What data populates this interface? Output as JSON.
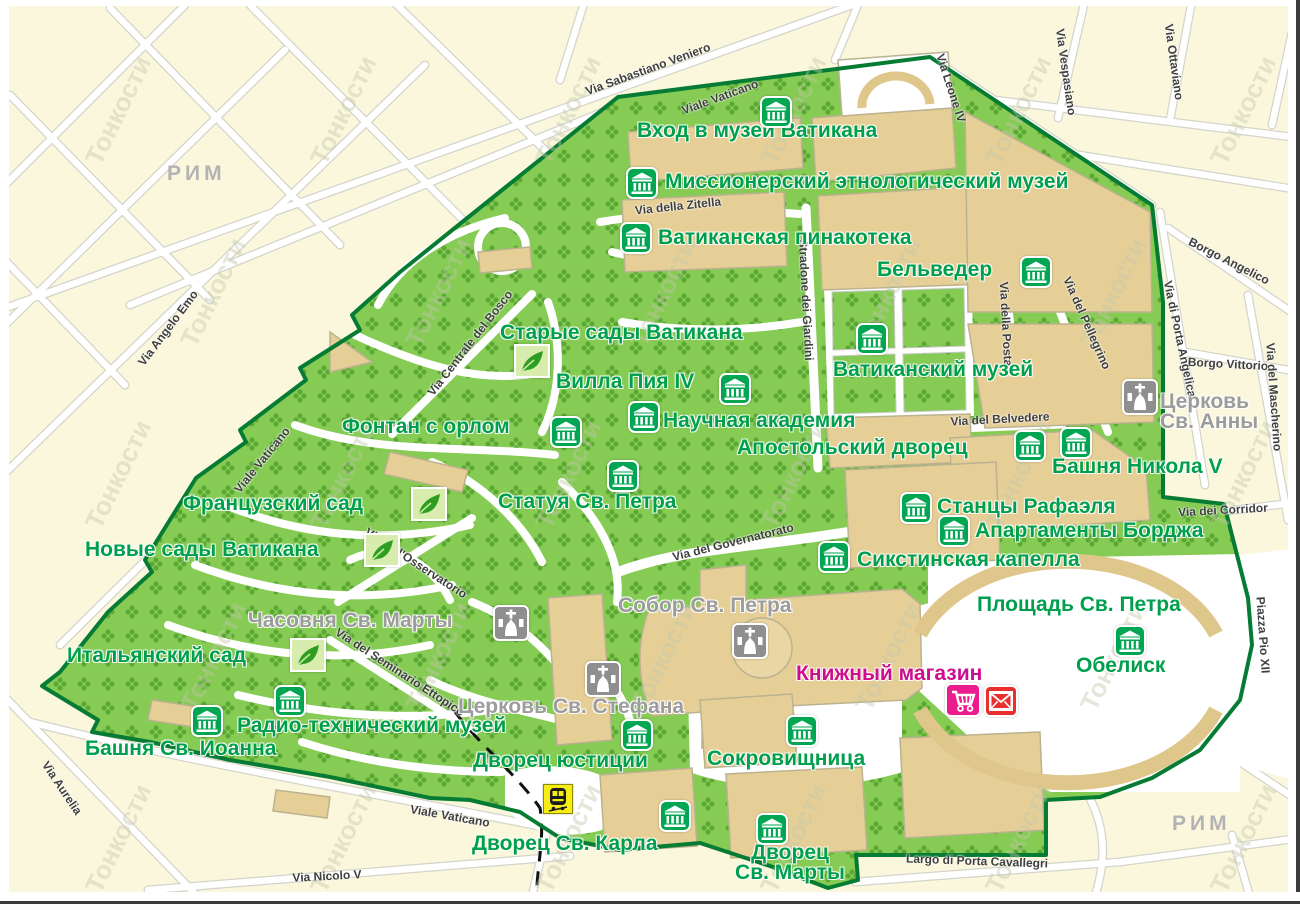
{
  "map": {
    "title": "Карта Ватикана",
    "watermark": "Тонкости",
    "region_labels": [
      {
        "id": "rim-nw",
        "label": "РИМ",
        "x": 167,
        "y": 162
      },
      {
        "id": "rim-se",
        "label": "РИМ",
        "x": 1172,
        "y": 812
      }
    ],
    "colors": {
      "outside_cream": "#FAF7DC",
      "vatican_green": "#85CB54",
      "pattern_green": "#5AA833",
      "building_tan": "#E6CF97",
      "border_green": "#067B33",
      "museum_icon_green": "#00A651",
      "label_green": "#009F4D",
      "label_gray": "#9C9C9C",
      "label_magenta": "#CC0D8E",
      "cart_pink": "#EC1C8E",
      "envelope_red": "#E8312F",
      "train_yellow": "#F7EC13",
      "church_icon_gray": "#8F8F8F"
    },
    "pois": [
      {
        "id": "vhod-muzey",
        "label": "Вход в музей Ватикана",
        "type": "museum",
        "x": 637,
        "y": 121,
        "icons": [
          {
            "type": "museum",
            "x": 776,
            "y": 112
          }
        ]
      },
      {
        "id": "missionerskiy-muzey",
        "label": "Миссионерский этнологический музей",
        "type": "museum",
        "x": 665,
        "y": 172,
        "icons": [
          {
            "type": "museum",
            "x": 642,
            "y": 183
          }
        ]
      },
      {
        "id": "pinakoteka",
        "label": "Ватиканская пинакотека",
        "type": "museum",
        "x": 658,
        "y": 228,
        "icons": [
          {
            "type": "museum",
            "x": 636,
            "y": 238
          }
        ]
      },
      {
        "id": "belveder",
        "label": "Бельведер",
        "type": "museum",
        "x": 877,
        "y": 260,
        "icons": [
          {
            "type": "museum",
            "x": 1036,
            "y": 272
          }
        ]
      },
      {
        "id": "starye-sady",
        "label": "Старые сады Ватикана",
        "type": "garden",
        "x": 500,
        "y": 323,
        "icons": [
          {
            "type": "leaf",
            "x": 532,
            "y": 361
          }
        ]
      },
      {
        "id": "villa-pia",
        "label": "Вилла Пия IV",
        "type": "museum",
        "x": 556,
        "y": 372,
        "icons": [
          {
            "type": "museum",
            "x": 735,
            "y": 389
          }
        ]
      },
      {
        "id": "vatikanskiy-muzey",
        "label": "Ватиканский музей",
        "type": "museum",
        "x": 833,
        "y": 360,
        "icons": [
          {
            "type": "museum",
            "x": 872,
            "y": 339
          }
        ]
      },
      {
        "id": "fontan-s-orlom",
        "label": "Фонтан с орлом",
        "type": "museum",
        "x": 342,
        "y": 417,
        "icons": [
          {
            "type": "museum",
            "x": 566,
            "y": 432
          }
        ]
      },
      {
        "id": "nauchnaya-akademiya",
        "label": "Научная академия",
        "type": "museum",
        "x": 663,
        "y": 411,
        "icons": [
          {
            "type": "museum",
            "x": 644,
            "y": 417
          }
        ]
      },
      {
        "id": "apostolskiy-dvorets",
        "label": "Апостольский дворец",
        "type": "museum",
        "x": 737,
        "y": 438,
        "icons": [
          {
            "type": "museum",
            "x": 1030,
            "y": 446
          }
        ]
      },
      {
        "id": "bashnya-nikola",
        "label": "Башня Никола V",
        "type": "museum",
        "x": 1052,
        "y": 457,
        "icons": [
          {
            "type": "museum",
            "x": 1076,
            "y": 443
          }
        ]
      },
      {
        "id": "tserkov-anny",
        "label": "Церковь\nСв. Анны",
        "type": "church",
        "x": 1160,
        "y": 392,
        "icons": [
          {
            "type": "church",
            "x": 1140,
            "y": 397
          }
        ]
      },
      {
        "id": "stantsy-rafaelya",
        "label": "Станцы Рафаэля",
        "type": "museum",
        "x": 937,
        "y": 497,
        "icons": [
          {
            "type": "museum",
            "x": 916,
            "y": 508
          }
        ]
      },
      {
        "id": "apartamenty-bordzha",
        "label": "Апартаменты Борджа",
        "type": "museum",
        "x": 975,
        "y": 521,
        "icons": [
          {
            "type": "museum",
            "x": 954,
            "y": 531
          }
        ]
      },
      {
        "id": "sikstinskaya-kapella",
        "label": "Сикстинская капелла",
        "type": "museum",
        "x": 857,
        "y": 550,
        "icons": [
          {
            "type": "museum",
            "x": 834,
            "y": 557
          }
        ]
      },
      {
        "id": "sobor-sv-petra",
        "label": "Собор Св. Петра",
        "type": "church",
        "x": 618,
        "y": 596,
        "icons": [
          {
            "type": "church",
            "x": 750,
            "y": 641
          }
        ]
      },
      {
        "id": "ploshchad-sv-petra",
        "label": "Площадь Св. Петра",
        "type": "plaza",
        "x": 977,
        "y": 595,
        "icons": []
      },
      {
        "id": "obelisk",
        "label": "Обелиск",
        "type": "museum",
        "x": 1076,
        "y": 656,
        "icons": [
          {
            "type": "museum",
            "x": 1130,
            "y": 641
          }
        ]
      },
      {
        "id": "knizhny-magazin",
        "label": "Книжный магазин",
        "type": "shop",
        "x": 796,
        "y": 664,
        "icons": [
          {
            "type": "cart",
            "x": 963,
            "y": 700
          },
          {
            "type": "envelope",
            "x": 1001,
            "y": 701
          }
        ]
      },
      {
        "id": "statuya-sv-petra",
        "label": "Статуя Св. Петра",
        "type": "museum",
        "x": 498,
        "y": 492,
        "icons": [
          {
            "type": "museum",
            "x": 623,
            "y": 476
          }
        ]
      },
      {
        "id": "frantsuzskiy-sad",
        "label": "Французский сад",
        "type": "garden",
        "x": 183,
        "y": 494,
        "icons": [
          {
            "type": "leaf",
            "x": 429,
            "y": 504
          }
        ]
      },
      {
        "id": "novye-sady",
        "label": "Новые сады Ватикана",
        "type": "garden",
        "x": 85,
        "y": 540,
        "icons": [
          {
            "type": "leaf",
            "x": 382,
            "y": 550
          }
        ]
      },
      {
        "id": "chasovnya-sv-marty",
        "label": "Часовня Св. Марты",
        "type": "church",
        "x": 248,
        "y": 611,
        "icons": [
          {
            "type": "church",
            "x": 511,
            "y": 623
          }
        ]
      },
      {
        "id": "italyanskiy-sad",
        "label": "Итальянский сад",
        "type": "garden",
        "x": 67,
        "y": 646,
        "icons": [
          {
            "type": "leaf",
            "x": 308,
            "y": 655
          }
        ]
      },
      {
        "id": "radio-muzey",
        "label": "Радио-технический музей",
        "type": "museum",
        "x": 237,
        "y": 716,
        "icons": [
          {
            "type": "museum",
            "x": 290,
            "y": 701
          }
        ]
      },
      {
        "id": "bashnya-ioanna",
        "label": "Башня Св. Иоанна",
        "type": "museum",
        "x": 85,
        "y": 739,
        "icons": [
          {
            "type": "museum",
            "x": 207,
            "y": 721
          }
        ]
      },
      {
        "id": "dvorets-yustitsii",
        "label": "Дворец юстиции",
        "type": "museum",
        "x": 473,
        "y": 751,
        "icons": [
          {
            "type": "museum",
            "x": 637,
            "y": 735
          }
        ]
      },
      {
        "id": "sokrovishchnitsa",
        "label": "Сокровищница",
        "type": "museum",
        "x": 707,
        "y": 749,
        "icons": [
          {
            "type": "museum",
            "x": 802,
            "y": 731
          }
        ]
      },
      {
        "id": "dvorets-karla",
        "label": "Дворец Св. Карла",
        "type": "museum",
        "x": 472,
        "y": 834,
        "icons": [
          {
            "type": "museum",
            "x": 675,
            "y": 816
          }
        ]
      },
      {
        "id": "dvorets-marty",
        "label": "Дворец\nСв. Марты",
        "type": "museum",
        "x": 790,
        "y": 843,
        "align": "center",
        "icons": [
          {
            "type": "museum",
            "x": 772,
            "y": 829
          }
        ]
      },
      {
        "id": "tserkov-stefana",
        "label": "Церковь Св. Стефана",
        "type": "church",
        "x": 458,
        "y": 697,
        "icons": [
          {
            "type": "church",
            "x": 603,
            "y": 679
          }
        ]
      },
      {
        "id": "station",
        "label": "",
        "type": "station",
        "x": 558,
        "y": 799,
        "icons": [
          {
            "type": "train",
            "x": 558,
            "y": 799
          }
        ]
      }
    ],
    "streets": [
      {
        "name": "Via Sabastiano Veniero",
        "x": 648,
        "y": 69,
        "rot": -20
      },
      {
        "name": "Viale Vaticano",
        "x": 720,
        "y": 97,
        "rot": -20
      },
      {
        "name": "Via Leone IV",
        "x": 951,
        "y": 88,
        "rot": 72
      },
      {
        "name": "Via Vespasiano",
        "x": 1066,
        "y": 72,
        "rot": 82
      },
      {
        "name": "Via Ottaviano",
        "x": 1174,
        "y": 62,
        "rot": 82
      },
      {
        "name": "Borgo Angelico",
        "x": 1229,
        "y": 261,
        "rot": 27
      },
      {
        "name": "Borgo Vittorio",
        "x": 1228,
        "y": 364,
        "rot": 3
      },
      {
        "name": "Via del Mascherino",
        "x": 1274,
        "y": 397,
        "rot": 86
      },
      {
        "name": "Via di Porta Angelica",
        "x": 1180,
        "y": 339,
        "rot": 78
      },
      {
        "name": "Via del Pellegrino",
        "x": 1087,
        "y": 323,
        "rot": 66
      },
      {
        "name": "Via della Posta",
        "x": 1006,
        "y": 324,
        "rot": 87
      },
      {
        "name": "Via del Belvedere",
        "x": 1000,
        "y": 419,
        "rot": -3
      },
      {
        "name": "Stradone dei Giardini",
        "x": 806,
        "y": 300,
        "rot": 87
      },
      {
        "name": "Via della Zitella",
        "x": 678,
        "y": 206,
        "rot": -6
      },
      {
        "name": "Via Centrale del Bosco",
        "x": 470,
        "y": 343,
        "rot": -52
      },
      {
        "name": "Via del Governatorato",
        "x": 733,
        "y": 542,
        "rot": -14
      },
      {
        "name": "Via dell'Osservatorio",
        "x": 416,
        "y": 563,
        "rot": 33
      },
      {
        "name": "Via del Seminario Ettopico",
        "x": 400,
        "y": 672,
        "rot": 33
      },
      {
        "name": "Via Angelo Emo",
        "x": 168,
        "y": 328,
        "rot": -53
      },
      {
        "name": "Viale Vaticano",
        "x": 262,
        "y": 460,
        "rot": -51
      },
      {
        "name": "Via Aurelia",
        "x": 62,
        "y": 788,
        "rot": 56
      },
      {
        "name": "Viale Vaticano",
        "x": 450,
        "y": 816,
        "rot": 10
      },
      {
        "name": "Via Nicolo V",
        "x": 327,
        "y": 876,
        "rot": -3
      },
      {
        "name": "Largo di Porta Cavallegri",
        "x": 977,
        "y": 861,
        "rot": 2
      },
      {
        "name": "Piazza Pio XII",
        "x": 1263,
        "y": 635,
        "rot": 86
      },
      {
        "name": "Via dei Corridor",
        "x": 1223,
        "y": 510,
        "rot": -3
      }
    ]
  }
}
